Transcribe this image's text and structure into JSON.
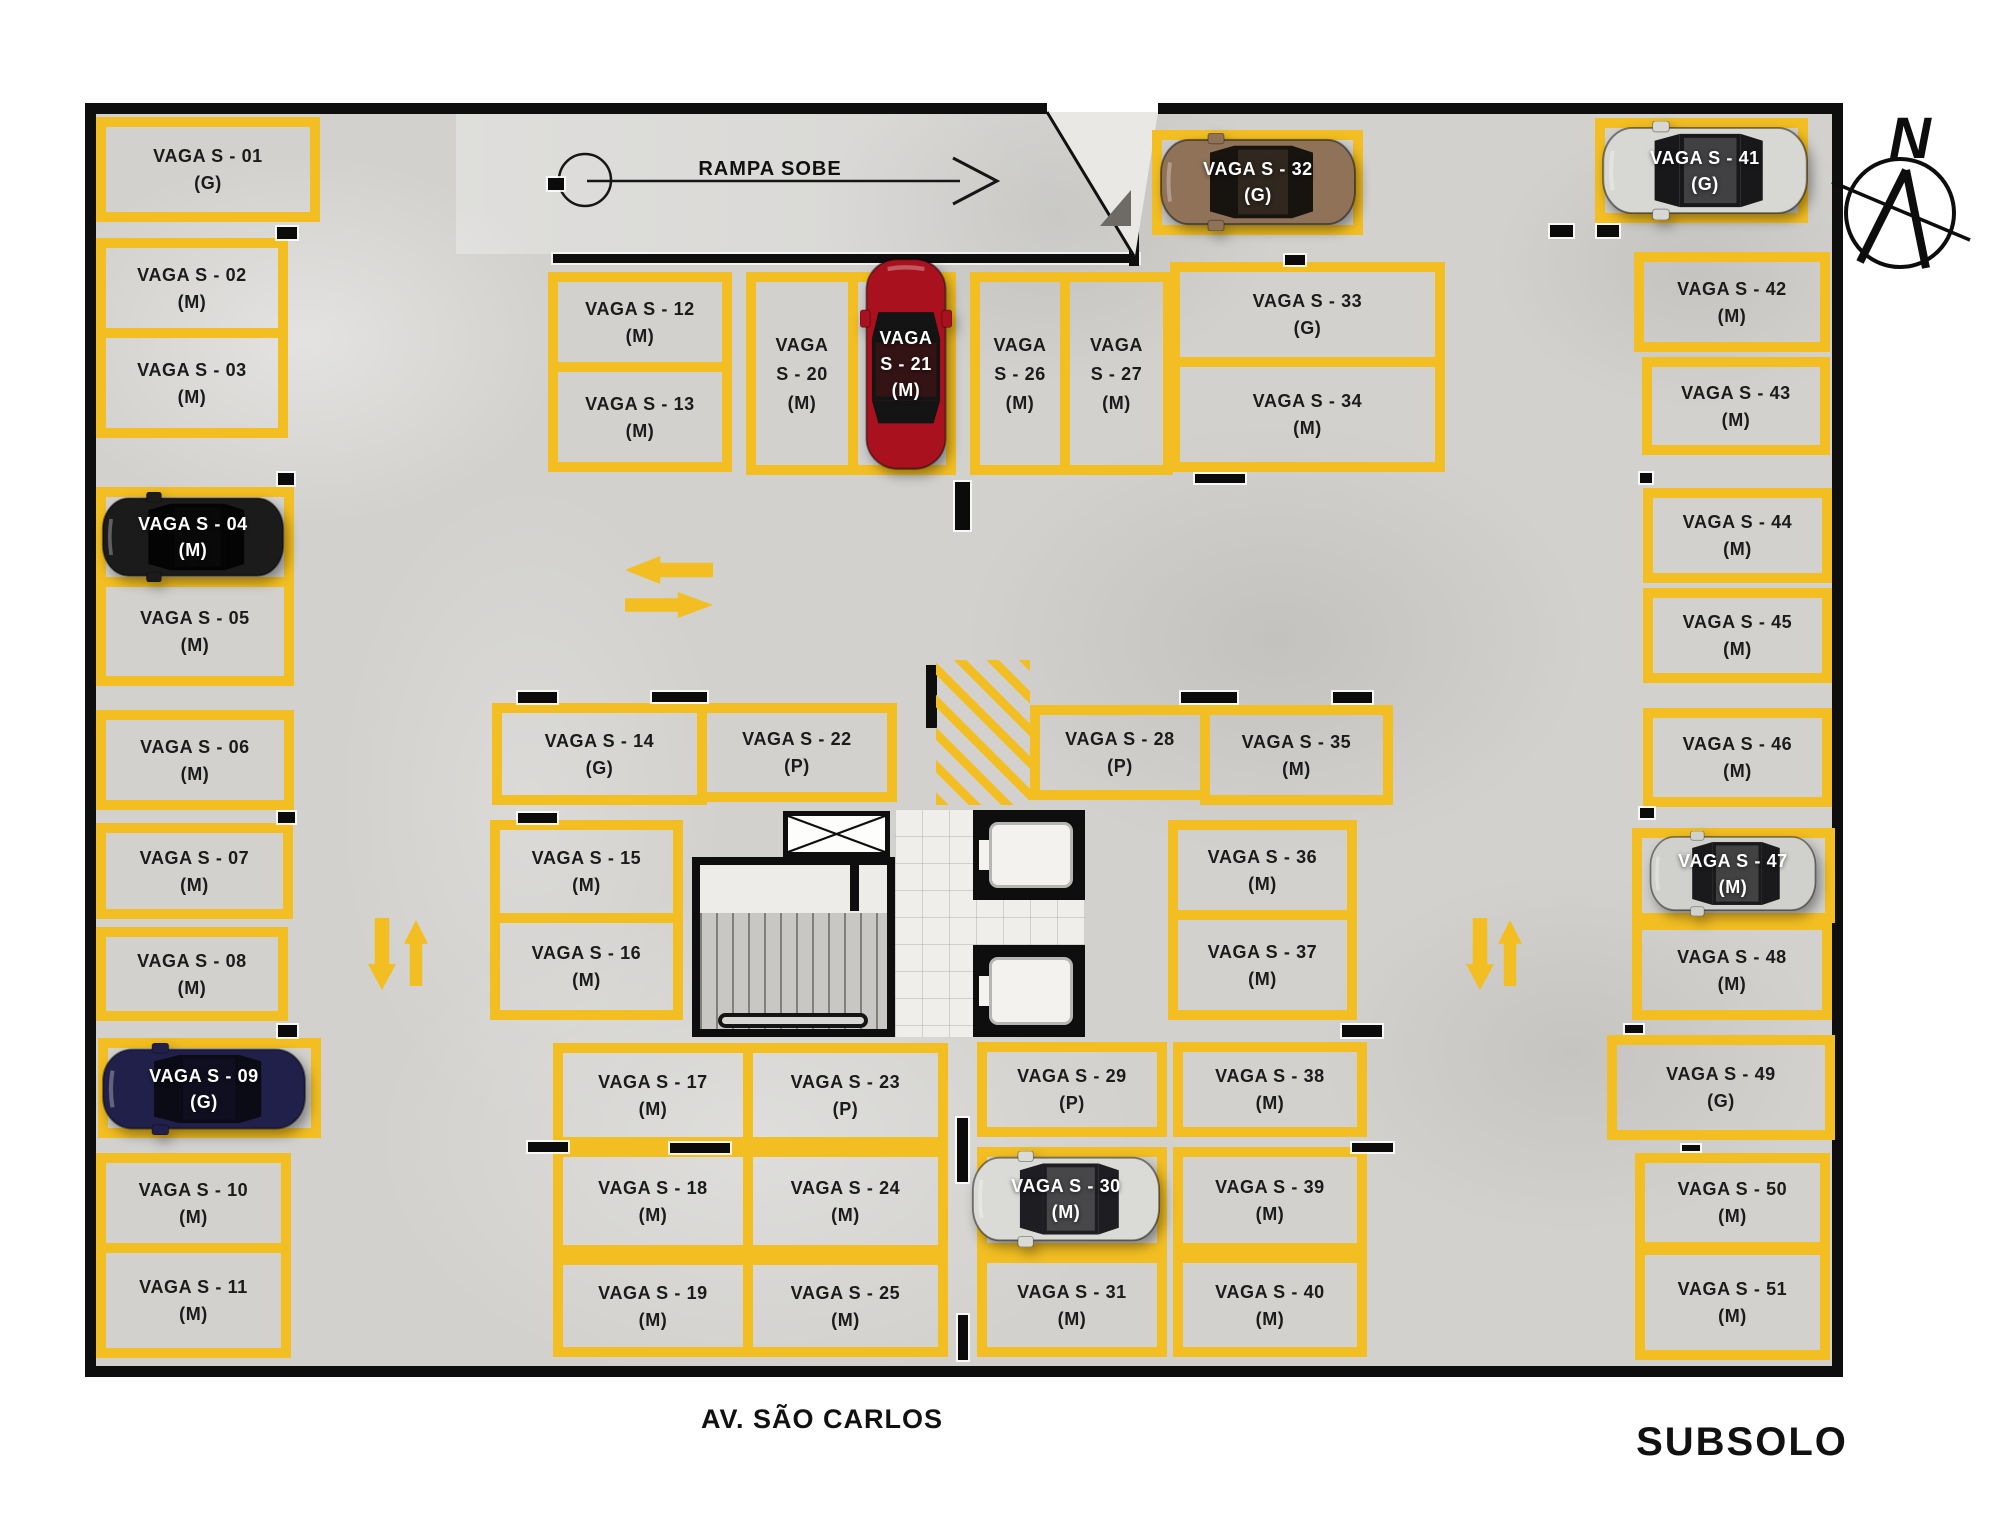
{
  "labels": {
    "ramp": "RAMPA SOBE",
    "street": "AV. SÃO CARLOS",
    "floor": "SUBSOLO",
    "compass_n": "N"
  },
  "colors": {
    "yellow": "#F2BE22",
    "wall": "#0E0E0E",
    "floor_concrete": "#D2D1CE",
    "stall_text": "#1B1B1B",
    "car_label_text": "#FFFFFF"
  },
  "stalls": [
    {
      "label": "VAGA S - 01",
      "size": "(G)",
      "x": 96,
      "y": 117,
      "w": 224,
      "h": 105,
      "o": "h"
    },
    {
      "label": "VAGA S - 02",
      "size": "(M)",
      "x": 96,
      "y": 238,
      "w": 192,
      "h": 100,
      "o": "h"
    },
    {
      "label": "VAGA S - 03",
      "size": "(M)",
      "x": 96,
      "y": 328,
      "w": 192,
      "h": 110,
      "o": "h"
    },
    {
      "label": "VAGA S - 04",
      "size": "(M)",
      "x": 96,
      "y": 487,
      "w": 198,
      "h": 100,
      "o": "h",
      "car": {
        "body": "#1B1B1B",
        "glass": "#040404",
        "x": 100,
        "y": 492,
        "w": 186,
        "h": 90,
        "o": "h"
      }
    },
    {
      "label": "VAGA S - 05",
      "size": "(M)",
      "x": 96,
      "y": 577,
      "w": 198,
      "h": 109,
      "o": "h"
    },
    {
      "label": "VAGA S - 06",
      "size": "(M)",
      "x": 96,
      "y": 710,
      "w": 198,
      "h": 100,
      "o": "h"
    },
    {
      "label": "VAGA S - 07",
      "size": "(M)",
      "x": 96,
      "y": 823,
      "w": 197,
      "h": 96,
      "o": "h"
    },
    {
      "label": "VAGA S - 08",
      "size": "(M)",
      "x": 96,
      "y": 927,
      "w": 192,
      "h": 94,
      "o": "h"
    },
    {
      "label": "VAGA S - 09",
      "size": "(G)",
      "x": 98,
      "y": 1038,
      "w": 223,
      "h": 100,
      "o": "h",
      "car": {
        "body": "#20204A",
        "glass": "#0B0B16",
        "x": 100,
        "y": 1043,
        "w": 208,
        "h": 92,
        "o": "h"
      }
    },
    {
      "label": "VAGA S - 10",
      "size": "(M)",
      "x": 96,
      "y": 1153,
      "w": 195,
      "h": 100,
      "o": "h"
    },
    {
      "label": "VAGA S - 11",
      "size": "(M)",
      "x": 96,
      "y": 1243,
      "w": 195,
      "h": 115,
      "o": "h"
    },
    {
      "label": "VAGA S - 12",
      "size": "(M)",
      "x": 548,
      "y": 272,
      "w": 184,
      "h": 100,
      "o": "h"
    },
    {
      "label": "VAGA S - 13",
      "size": "(M)",
      "x": 548,
      "y": 362,
      "w": 184,
      "h": 110,
      "o": "h"
    },
    {
      "label": "VAGA S - 14",
      "size": "(G)",
      "x": 492,
      "y": 703,
      "w": 215,
      "h": 102,
      "o": "h"
    },
    {
      "label": "VAGA S - 15",
      "size": "(M)",
      "x": 490,
      "y": 820,
      "w": 193,
      "h": 103,
      "o": "h"
    },
    {
      "label": "VAGA S - 16",
      "size": "(M)",
      "x": 490,
      "y": 913,
      "w": 193,
      "h": 107,
      "o": "h"
    },
    {
      "label": "VAGA S - 17",
      "size": "(M)",
      "x": 553,
      "y": 1043,
      "w": 200,
      "h": 104,
      "o": "h"
    },
    {
      "label": "VAGA S - 18",
      "size": "(M)",
      "x": 553,
      "y": 1147,
      "w": 200,
      "h": 108,
      "o": "h"
    },
    {
      "label": "VAGA S - 19",
      "size": "(M)",
      "x": 553,
      "y": 1255,
      "w": 200,
      "h": 102,
      "o": "h"
    },
    {
      "label": "VAGA S - 20",
      "size": "(M)",
      "x": 746,
      "y": 272,
      "w": 112,
      "h": 203,
      "o": "v"
    },
    {
      "label": "VAGA S - 21",
      "size": "(M)",
      "x": 848,
      "y": 272,
      "w": 108,
      "h": 203,
      "o": "v",
      "car": {
        "body": "#A8111D",
        "glass": "#141414",
        "x": 860,
        "y": 256,
        "w": 92,
        "h": 216,
        "o": "v"
      }
    },
    {
      "label": "VAGA S - 22",
      "size": "(P)",
      "x": 697,
      "y": 703,
      "w": 200,
      "h": 99,
      "o": "h"
    },
    {
      "label": "VAGA S - 23",
      "size": "(P)",
      "x": 743,
      "y": 1043,
      "w": 205,
      "h": 104,
      "o": "h"
    },
    {
      "label": "VAGA S - 24",
      "size": "(M)",
      "x": 743,
      "y": 1147,
      "w": 205,
      "h": 108,
      "o": "h"
    },
    {
      "label": "VAGA S - 25",
      "size": "(M)",
      "x": 743,
      "y": 1255,
      "w": 205,
      "h": 102,
      "o": "h"
    },
    {
      "label": "VAGA S - 26",
      "size": "(M)",
      "x": 970,
      "y": 272,
      "w": 100,
      "h": 203,
      "o": "v"
    },
    {
      "label": "VAGA S - 27",
      "size": "(M)",
      "x": 1060,
      "y": 272,
      "w": 113,
      "h": 203,
      "o": "v"
    },
    {
      "label": "VAGA S - 28",
      "size": "(P)",
      "x": 1030,
      "y": 705,
      "w": 180,
      "h": 95,
      "o": "h"
    },
    {
      "label": "VAGA S - 29",
      "size": "(P)",
      "x": 977,
      "y": 1042,
      "w": 190,
      "h": 95,
      "o": "h"
    },
    {
      "label": "VAGA S - 30",
      "size": "(M)",
      "x": 977,
      "y": 1147,
      "w": 190,
      "h": 106,
      "o": "h",
      "car": {
        "body": "#DADAD7",
        "glass": "#1E1E22",
        "x": 970,
        "y": 1151,
        "w": 192,
        "h": 96,
        "o": "h"
      }
    },
    {
      "label": "VAGA S - 31",
      "size": "(M)",
      "x": 977,
      "y": 1253,
      "w": 190,
      "h": 104,
      "o": "h"
    },
    {
      "label": "VAGA S - 32",
      "size": "(G)",
      "x": 1152,
      "y": 130,
      "w": 211,
      "h": 105,
      "o": "h",
      "car": {
        "body": "#8F7258",
        "glass": "#17130F",
        "x": 1158,
        "y": 133,
        "w": 200,
        "h": 98,
        "o": "h"
      }
    },
    {
      "label": "VAGA S - 33",
      "size": "(G)",
      "x": 1170,
      "y": 262,
      "w": 275,
      "h": 105,
      "o": "h"
    },
    {
      "label": "VAGA S - 34",
      "size": "(M)",
      "x": 1170,
      "y": 357,
      "w": 275,
      "h": 115,
      "o": "h"
    },
    {
      "label": "VAGA S - 35",
      "size": "(M)",
      "x": 1200,
      "y": 705,
      "w": 193,
      "h": 100,
      "o": "h"
    },
    {
      "label": "VAGA S - 36",
      "size": "(M)",
      "x": 1168,
      "y": 820,
      "w": 189,
      "h": 100,
      "o": "h"
    },
    {
      "label": "VAGA S - 37",
      "size": "(M)",
      "x": 1168,
      "y": 910,
      "w": 189,
      "h": 110,
      "o": "h"
    },
    {
      "label": "VAGA S - 38",
      "size": "(M)",
      "x": 1173,
      "y": 1042,
      "w": 194,
      "h": 95,
      "o": "h"
    },
    {
      "label": "VAGA S - 39",
      "size": "(M)",
      "x": 1173,
      "y": 1147,
      "w": 194,
      "h": 106,
      "o": "h"
    },
    {
      "label": "VAGA S - 40",
      "size": "(M)",
      "x": 1173,
      "y": 1253,
      "w": 194,
      "h": 104,
      "o": "h"
    },
    {
      "label": "VAGA S - 41",
      "size": "(G)",
      "x": 1595,
      "y": 118,
      "w": 213,
      "h": 105,
      "o": "h",
      "car": {
        "body": "#D7D7D4",
        "glass": "#18181B",
        "x": 1600,
        "y": 121,
        "w": 210,
        "h": 99,
        "o": "h"
      }
    },
    {
      "label": "VAGA S - 42",
      "size": "(M)",
      "x": 1634,
      "y": 252,
      "w": 196,
      "h": 100,
      "o": "h"
    },
    {
      "label": "VAGA S - 43",
      "size": "(M)",
      "x": 1642,
      "y": 357,
      "w": 188,
      "h": 98,
      "o": "h"
    },
    {
      "label": "VAGA S - 44",
      "size": "(M)",
      "x": 1643,
      "y": 488,
      "w": 189,
      "h": 95,
      "o": "h"
    },
    {
      "label": "VAGA S - 45",
      "size": "(M)",
      "x": 1643,
      "y": 588,
      "w": 189,
      "h": 95,
      "o": "h"
    },
    {
      "label": "VAGA S - 46",
      "size": "(M)",
      "x": 1643,
      "y": 708,
      "w": 189,
      "h": 99,
      "o": "h"
    },
    {
      "label": "VAGA S - 47",
      "size": "(M)",
      "x": 1632,
      "y": 828,
      "w": 203,
      "h": 95,
      "o": "h",
      "car": {
        "body": "#D0D0CD",
        "glass": "#1A1A1D",
        "x": 1648,
        "y": 831,
        "w": 170,
        "h": 85,
        "o": "h"
      }
    },
    {
      "label": "VAGA S - 48",
      "size": "(M)",
      "x": 1632,
      "y": 920,
      "w": 200,
      "h": 100,
      "o": "h"
    },
    {
      "label": "VAGA S - 49",
      "size": "(G)",
      "x": 1607,
      "y": 1035,
      "w": 228,
      "h": 105,
      "o": "h"
    },
    {
      "label": "VAGA S - 50",
      "size": "(M)",
      "x": 1635,
      "y": 1153,
      "w": 195,
      "h": 99,
      "o": "h"
    },
    {
      "label": "VAGA S - 51",
      "size": "(M)",
      "x": 1635,
      "y": 1245,
      "w": 195,
      "h": 115,
      "o": "h"
    }
  ],
  "columns": [
    {
      "x": 277,
      "y": 227,
      "w": 20,
      "h": 12
    },
    {
      "x": 278,
      "y": 473,
      "w": 16,
      "h": 12
    },
    {
      "x": 278,
      "y": 812,
      "w": 17,
      "h": 11
    },
    {
      "x": 278,
      "y": 1025,
      "w": 19,
      "h": 12
    },
    {
      "x": 548,
      "y": 178,
      "w": 16,
      "h": 12
    },
    {
      "x": 518,
      "y": 692,
      "w": 39,
      "h": 11
    },
    {
      "x": 652,
      "y": 692,
      "w": 55,
      "h": 10
    },
    {
      "x": 518,
      "y": 813,
      "w": 39,
      "h": 10
    },
    {
      "x": 955,
      "y": 482,
      "w": 15,
      "h": 48
    },
    {
      "x": 1195,
      "y": 474,
      "w": 50,
      "h": 9
    },
    {
      "x": 1285,
      "y": 255,
      "w": 20,
      "h": 10
    },
    {
      "x": 1181,
      "y": 692,
      "w": 56,
      "h": 11
    },
    {
      "x": 1333,
      "y": 692,
      "w": 39,
      "h": 11
    },
    {
      "x": 1550,
      "y": 225,
      "w": 23,
      "h": 12
    },
    {
      "x": 1597,
      "y": 225,
      "w": 22,
      "h": 12
    },
    {
      "x": 1640,
      "y": 473,
      "w": 12,
      "h": 10
    },
    {
      "x": 1640,
      "y": 808,
      "w": 14,
      "h": 10
    },
    {
      "x": 528,
      "y": 1142,
      "w": 40,
      "h": 10
    },
    {
      "x": 670,
      "y": 1143,
      "w": 60,
      "h": 10
    },
    {
      "x": 957,
      "y": 1118,
      "w": 11,
      "h": 64
    },
    {
      "x": 958,
      "y": 1315,
      "w": 10,
      "h": 45
    },
    {
      "x": 1352,
      "y": 1143,
      "w": 41,
      "h": 9
    },
    {
      "x": 1342,
      "y": 1025,
      "w": 40,
      "h": 12
    },
    {
      "x": 1625,
      "y": 1025,
      "w": 18,
      "h": 8
    },
    {
      "x": 1682,
      "y": 1145,
      "w": 18,
      "h": 6
    }
  ],
  "arrows": [
    {
      "dir": "left",
      "x": 625,
      "y": 556,
      "w": 88,
      "h": 28
    },
    {
      "dir": "right",
      "x": 625,
      "y": 592,
      "w": 88,
      "h": 26
    },
    {
      "dir": "down",
      "x": 368,
      "y": 918,
      "w": 28,
      "h": 72
    },
    {
      "dir": "up",
      "x": 404,
      "y": 920,
      "w": 24,
      "h": 66
    },
    {
      "dir": "down",
      "x": 1466,
      "y": 918,
      "w": 28,
      "h": 72
    },
    {
      "dir": "up",
      "x": 1498,
      "y": 920,
      "w": 24,
      "h": 66
    }
  ]
}
